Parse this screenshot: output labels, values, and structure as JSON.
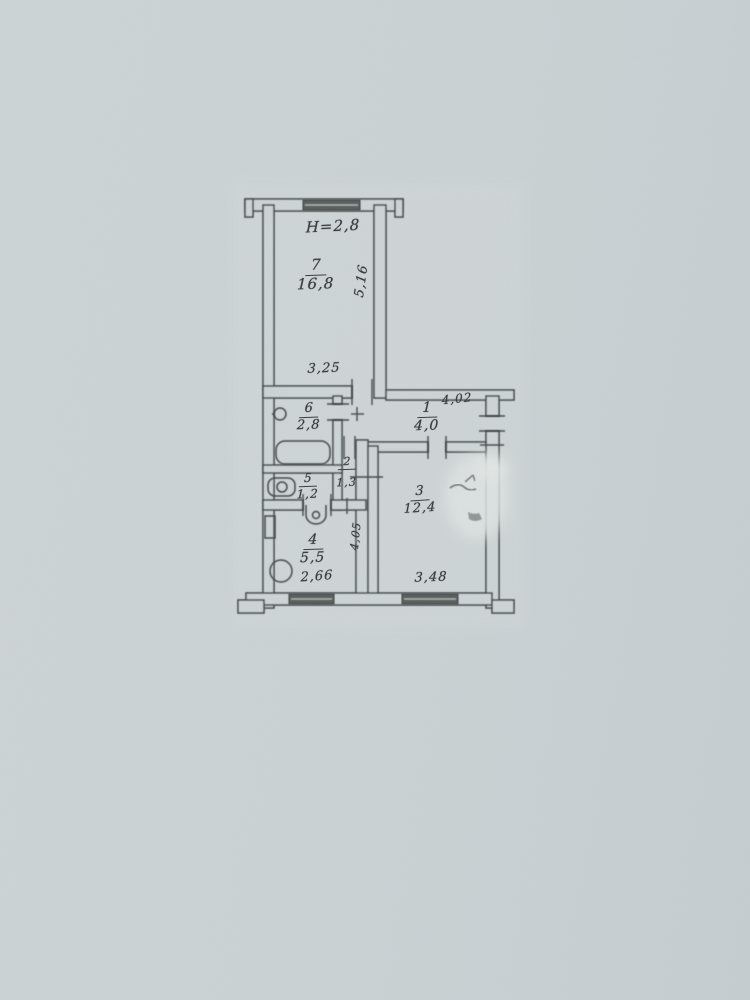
{
  "plan": {
    "ceiling_height_note": "H=2,8",
    "rooms": {
      "room7": {
        "number": "7",
        "area": "16,8"
      },
      "room1": {
        "number": "1",
        "area": "4,0"
      },
      "room6": {
        "number": "6",
        "area": "2,8"
      },
      "room5": {
        "number": "5",
        "area": "1,2"
      },
      "room2": {
        "number": "2",
        "area": "1,3"
      },
      "room3": {
        "number": "3",
        "area": "12,4"
      },
      "room4": {
        "number": "4",
        "area": "5,5"
      }
    },
    "dimensions": {
      "room7_width": "3,25",
      "room7_depth": "5,16",
      "corridor_length": "4,02",
      "room3_width": "3,48",
      "room3_depth": "4,05",
      "kitchen_width": "2,66"
    },
    "colors": {
      "background": "#ccd3d5",
      "ink": "#44484a"
    }
  }
}
